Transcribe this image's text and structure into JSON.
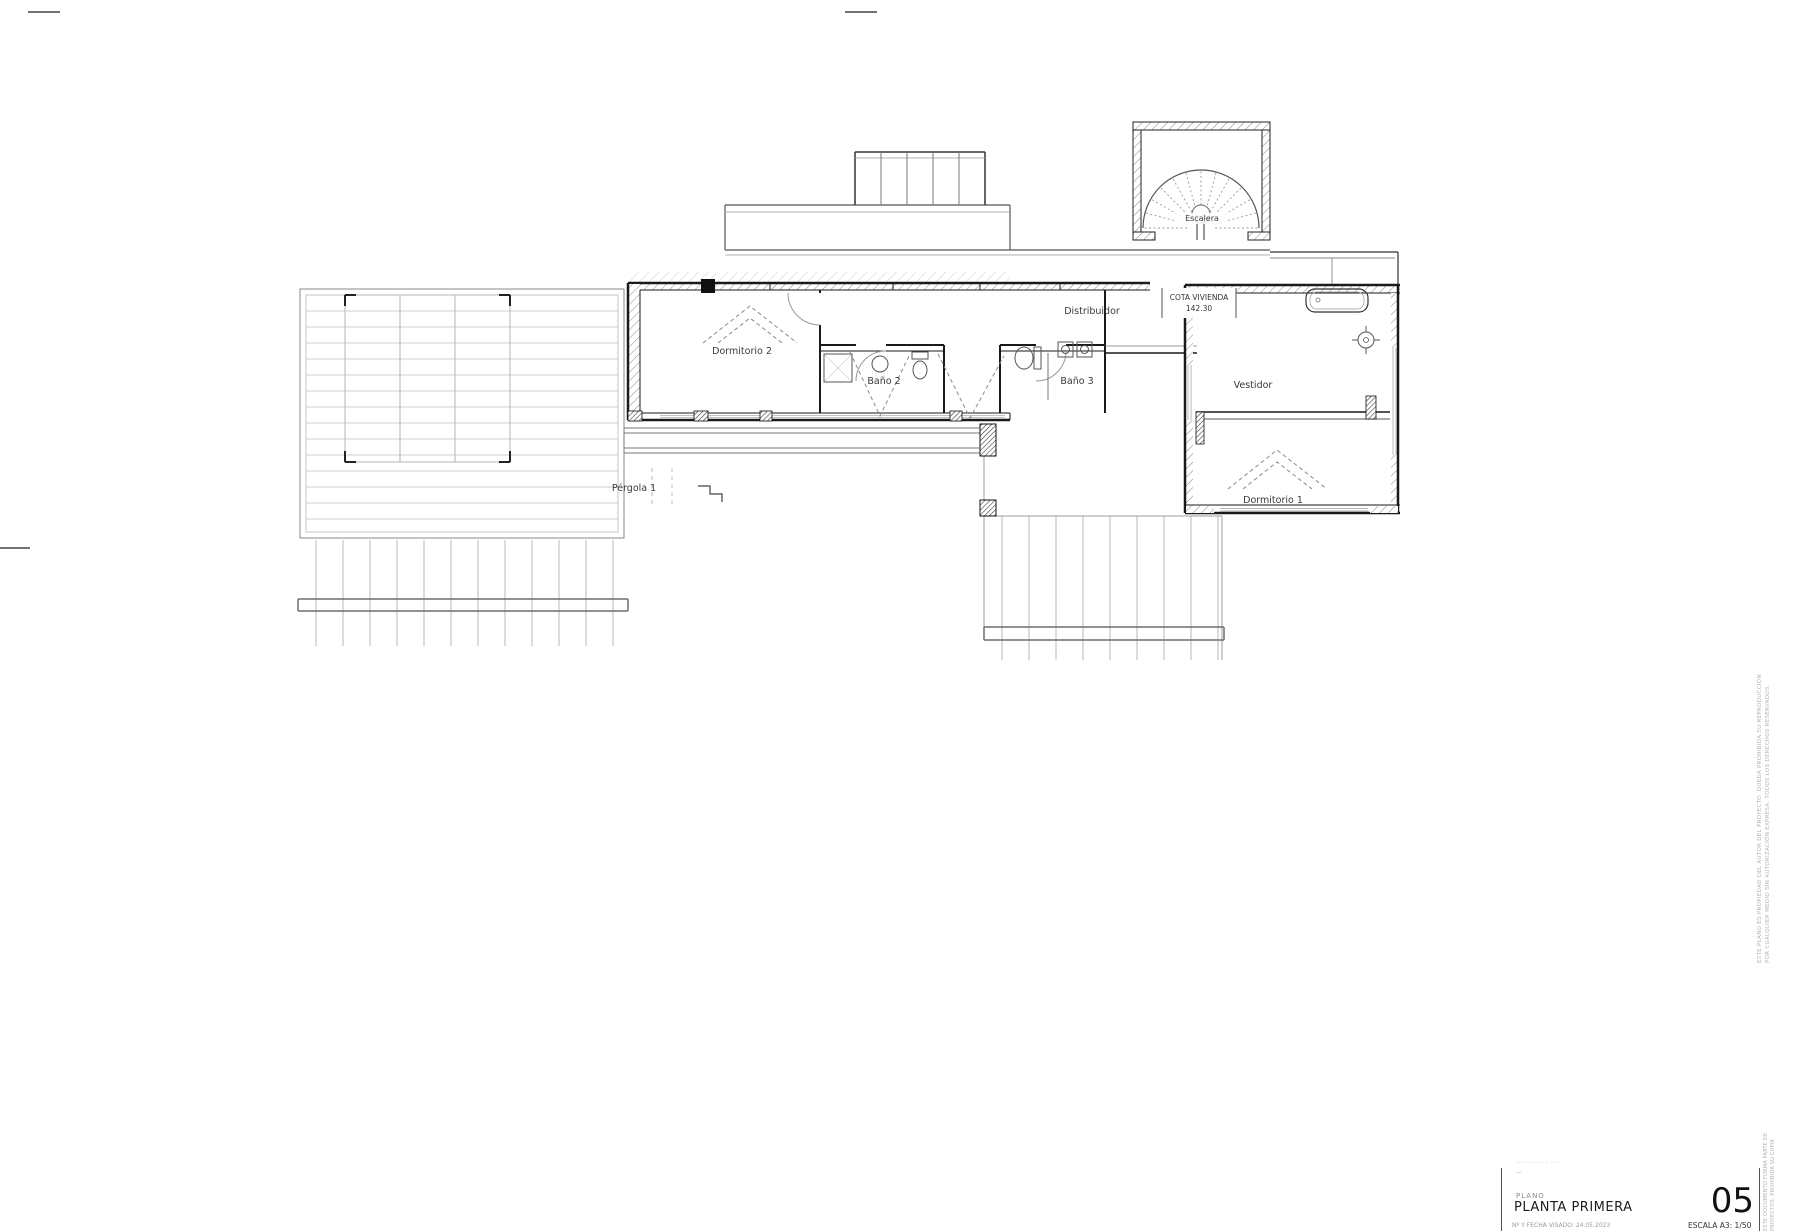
{
  "plan": {
    "rooms": {
      "dormitorio2": "Dormitorio 2",
      "bano2": "Baño 2",
      "bano3": "Baño 3",
      "distribuidor": "Distribuidor",
      "vestidor": "Vestidor",
      "dormitorio1": "Dormitorio 1",
      "escalera": "Escalera",
      "pergola": "Pérgola 1"
    },
    "cota": {
      "line1": "COTA VIVIENDA",
      "line2": "142.30"
    }
  },
  "titleblock": {
    "tiny_row_1": "··········· ···",
    "tiny_row_2": "—",
    "plano_label": "PLANO",
    "plano_value": "PLANTA PRIMERA",
    "sheet_number": "05",
    "visado_row": "Nº Y FECHA VISADO: 24.05.2023",
    "scale_row": "ESCALA A3: 1/50",
    "side_note_1": "ESTE DOCUMENTO FORMA PARTE DE",
    "side_note_2": "PROYECTOS. PROHIBIDA SU COPIA"
  },
  "edge_note": {
    "line1": "ESTE PLANO ES PROPIEDAD DEL AUTOR DEL PROYECTO. QUEDA PROHIBIDA SU REPRODUCCIÓN",
    "line2": "POR CUALQUIER MEDIO SIN AUTORIZACIÓN EXPRESA. TODOS LOS DERECHOS RESERVADOS."
  }
}
